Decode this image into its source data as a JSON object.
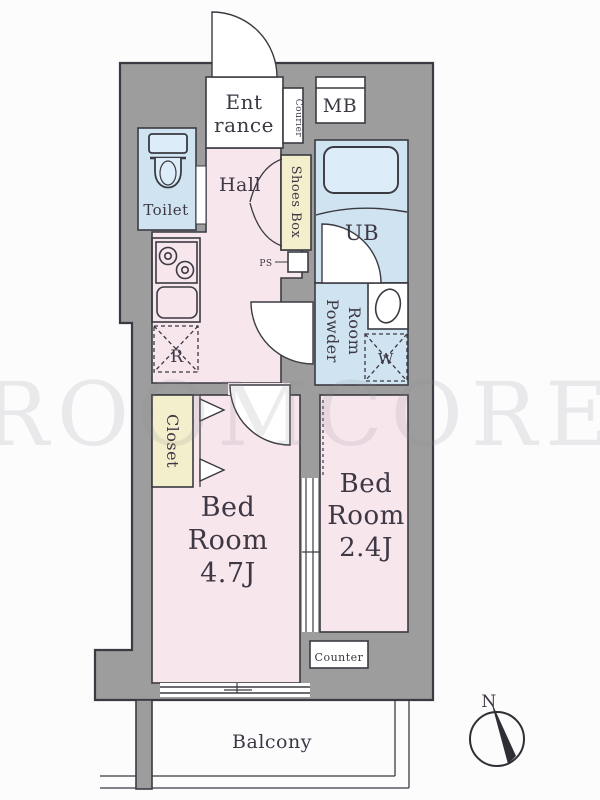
{
  "title": "apartment-floor-plan",
  "watermark": "ROOMCORE",
  "rooms": {
    "entrance": {
      "line1": "Ent",
      "line2": "rance"
    },
    "courier": "Courier",
    "mb": "MB",
    "toilet": "Toilet",
    "hall": "Hall",
    "shoes_box": "Shoes Box",
    "ub": "UB",
    "ps": "PS",
    "powder": {
      "line1": "Powder",
      "line2": "Room"
    },
    "washer": "W",
    "fridge": "R",
    "closet": "Closet",
    "bedroom1": {
      "line1": "Bed",
      "line2": "Room",
      "line3": "4.7J"
    },
    "bedroom2": {
      "line1": "Bed",
      "line2": "Room",
      "line3": "2.4J"
    },
    "counter": "Counter",
    "balcony": "Balcony"
  },
  "compass": {
    "north": "N"
  },
  "colors": {
    "wall": "#9d9d9d",
    "room_pink": "#f8e6ed",
    "room_blue": "#cfe3f1",
    "room_yellow": "#f3eecb",
    "fixture_blue": "#dcecf8",
    "line": "#3a3a42",
    "text": "#3e3744",
    "background": "#fcfcfd"
  }
}
